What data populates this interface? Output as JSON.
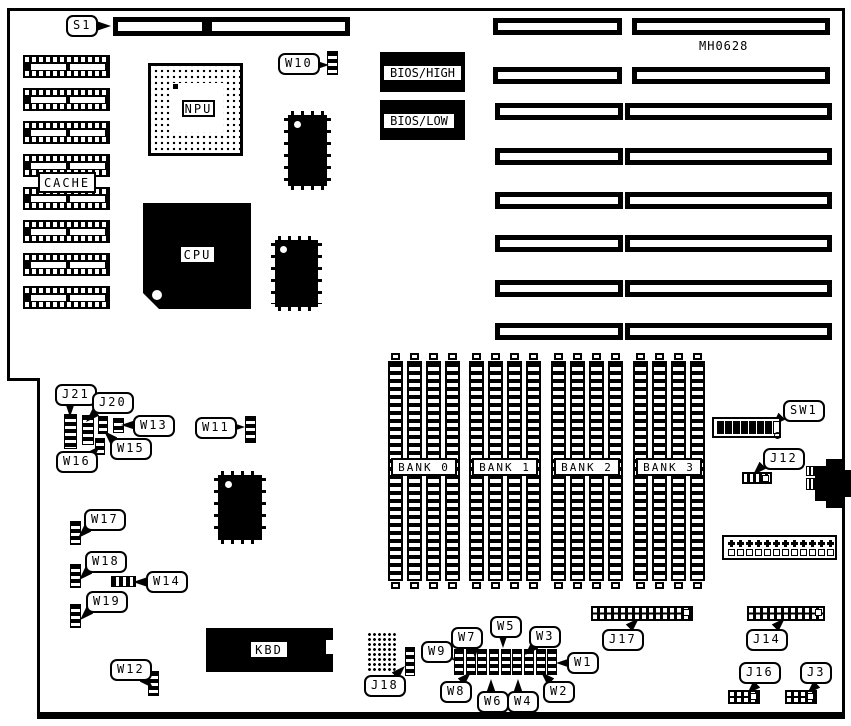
{
  "part_number": "MH0628",
  "labels": {
    "cpu": "CPU",
    "npu": "NPU",
    "cache": "CACHE",
    "kbd": "KBD",
    "bios_high": "BIOS/HIGH",
    "bios_low": "BIOS/LOW"
  },
  "banks": [
    "BANK 0",
    "BANK 1",
    "BANK 2",
    "BANK 3"
  ],
  "callouts": {
    "S1": "S1",
    "W10": "W10",
    "J21": "J21",
    "J20": "J20",
    "W13": "W13",
    "W15": "W15",
    "W16": "W16",
    "W11": "W11",
    "W17": "W17",
    "W18": "W18",
    "W14": "W14",
    "W19": "W19",
    "W12": "W12",
    "J18": "J18",
    "W9": "W9",
    "W7": "W7",
    "W5": "W5",
    "W3": "W3",
    "W1": "W1",
    "W8": "W8",
    "W6": "W6",
    "W4": "W4",
    "W2": "W2",
    "J17": "J17",
    "J14": "J14",
    "J16": "J16",
    "J3": "J3",
    "SW1": "SW1",
    "J12": "J12"
  }
}
